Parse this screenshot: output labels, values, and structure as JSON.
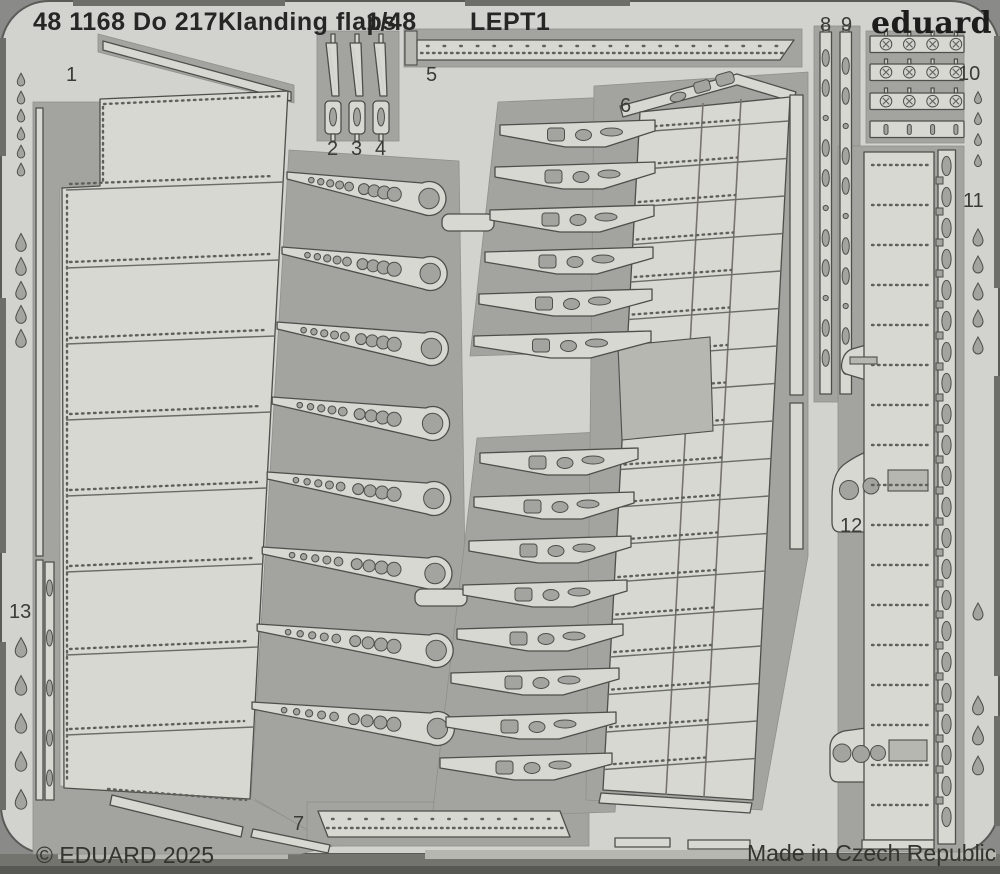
{
  "header": {
    "catalog_number": "48 1168",
    "model": "Do 217K",
    "description": "landing flaps",
    "scale": "1/48",
    "code": "LEPT1"
  },
  "brand": {
    "logo": "eduard"
  },
  "footer": {
    "copyright": "© EDUARD 2025",
    "made_in": "Made in Czech Republic"
  },
  "labels": {
    "p1": "1",
    "p2": "2",
    "p3": "3",
    "p4": "4",
    "p5": "5",
    "p6": "6",
    "p7": "7",
    "p8": "8",
    "p9": "9",
    "p10": "10",
    "p11": "11",
    "p12": "12",
    "p13": "13"
  },
  "colors": {
    "background": "#8a8a88",
    "sheet": "#d2d2ce",
    "part": "#d8d8d3",
    "cap": "#b7b7b2",
    "recess": "#a3a39f",
    "outline": "#4e4e4a",
    "dot": "#5f5f5b",
    "text": "#262624"
  }
}
